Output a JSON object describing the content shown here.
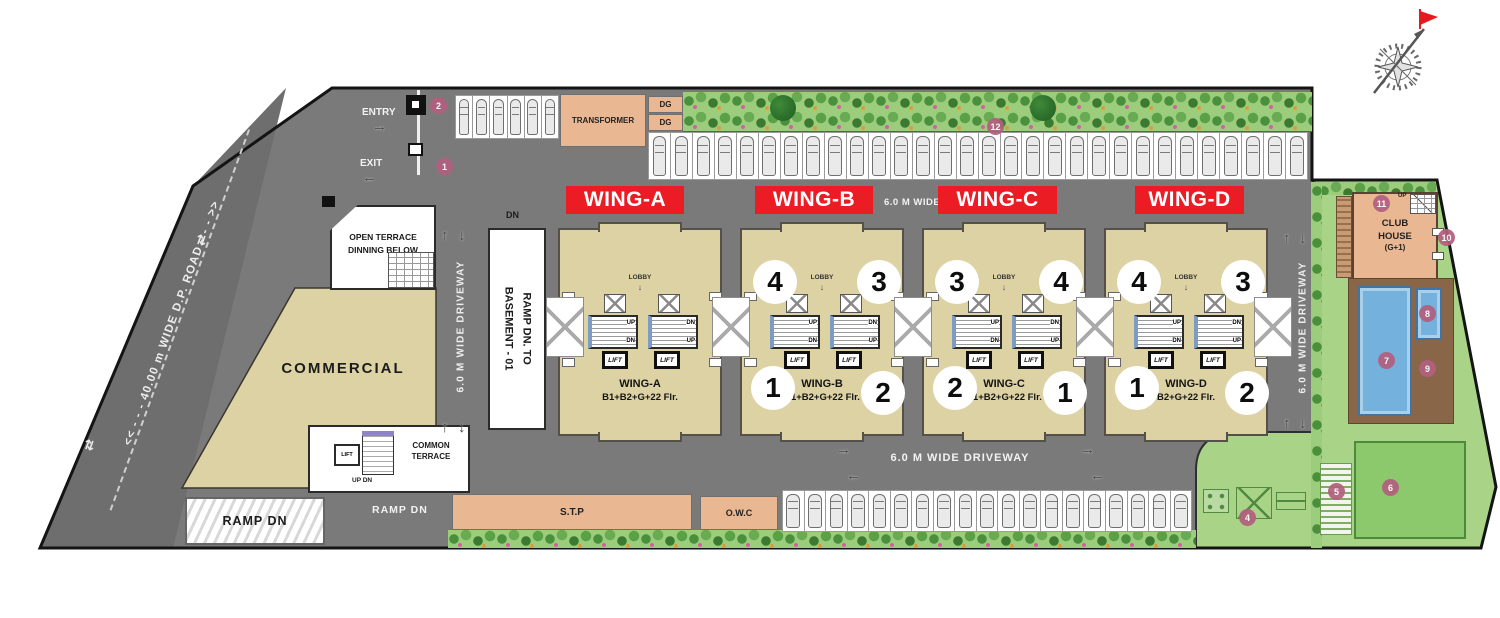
{
  "roads": {
    "dp_road": "<< - - - 40.00 m WIDE D.P. ROAD - - - >>",
    "driveway": "6.0 M WIDE DRIVEWAY",
    "entry": "ENTRY",
    "exit": "EXIT",
    "dn": "DN",
    "ramp_to_basement": [
      "RAMP DN. TO",
      "BASEMENT - 01"
    ],
    "ramp_dn_hatched": "RAMP DN",
    "ramp_dn_road": "RAMP DN"
  },
  "utilities": {
    "transformer": "TRANSFORMER",
    "dg_top": "DG",
    "dg_bottom": "DG",
    "stp": "S.T.P",
    "owc": "O.W.C"
  },
  "left_block": {
    "open_terrace": [
      "OPEN TERRACE",
      "DINNING BELOW"
    ],
    "commercial": "COMMERCIAL",
    "common_terrace": [
      "COMMON",
      "TERRACE"
    ],
    "lift": "LIFT",
    "up_dn": "UP DN"
  },
  "core": {
    "lobby": "LOBBY",
    "lift": "LIFT",
    "stair_left_top": "UP",
    "stair_left_bottom": "DN",
    "stair_right_top": "DN",
    "stair_right_bottom": "UP"
  },
  "wings": [
    {
      "banner": "WING-A",
      "name": "WING-A",
      "floors": "B1+B2+G+22 Flr.",
      "units_top": [],
      "units_bottom": []
    },
    {
      "banner": "WING-B",
      "name": "WING-B",
      "floors": "B1+B2+G+22 Flr.",
      "units_top": [
        "4",
        "3"
      ],
      "units_bottom": [
        "1",
        "2"
      ]
    },
    {
      "banner": "WING-C",
      "name": "WING-C",
      "floors": "B1+B2+G+22 Flr.",
      "units_top": [
        "3",
        "4"
      ],
      "units_bottom": [
        "2",
        "1"
      ]
    },
    {
      "banner": "WING-D",
      "name": "WING-D",
      "floors": "B2+G+22 Flr.",
      "units_top": [
        "4",
        "3"
      ],
      "units_bottom": [
        "1",
        "2"
      ]
    }
  ],
  "club": {
    "line1": "CLUB",
    "line2": "HOUSE",
    "line3": "(G+1)",
    "up": "UP"
  },
  "markers": [
    {
      "n": "2",
      "x": 438,
      "y": 105
    },
    {
      "n": "1",
      "x": 444,
      "y": 166
    },
    {
      "n": "12",
      "x": 995,
      "y": 126
    },
    {
      "n": "4",
      "x": 1247,
      "y": 517
    },
    {
      "n": "5",
      "x": 1336,
      "y": 491
    },
    {
      "n": "6",
      "x": 1390,
      "y": 487
    },
    {
      "n": "7",
      "x": 1386,
      "y": 360
    },
    {
      "n": "8",
      "x": 1427,
      "y": 313
    },
    {
      "n": "9",
      "x": 1427,
      "y": 368
    },
    {
      "n": "10",
      "x": 1446,
      "y": 237
    },
    {
      "n": "11",
      "x": 1381,
      "y": 203
    }
  ],
  "parking": {
    "top_bay_slots": 6,
    "top_row_slots": 30,
    "bottom_row_slots": 19
  },
  "icons": {
    "north_indicator": "compass-rose",
    "up_arrow": "↑",
    "down_arrow": "↓",
    "left_arrow": "←",
    "right_arrow": "→",
    "two_way_arrow": "⇄",
    "lobby_down_arrow": "↓"
  },
  "colors": {
    "road": "#7a7a7a",
    "dp_road": "#6e6e6e",
    "building_tan": "#ddd2a4",
    "utility_peach": "#e9b893",
    "wing_label_red": "#ec1c24",
    "marker_pink": "#b2607f",
    "pool_blue": "#74b1dd",
    "deck_brown": "#8a6648",
    "lawn_green": "#a9d488",
    "planting_green": "#9ccd7d"
  }
}
